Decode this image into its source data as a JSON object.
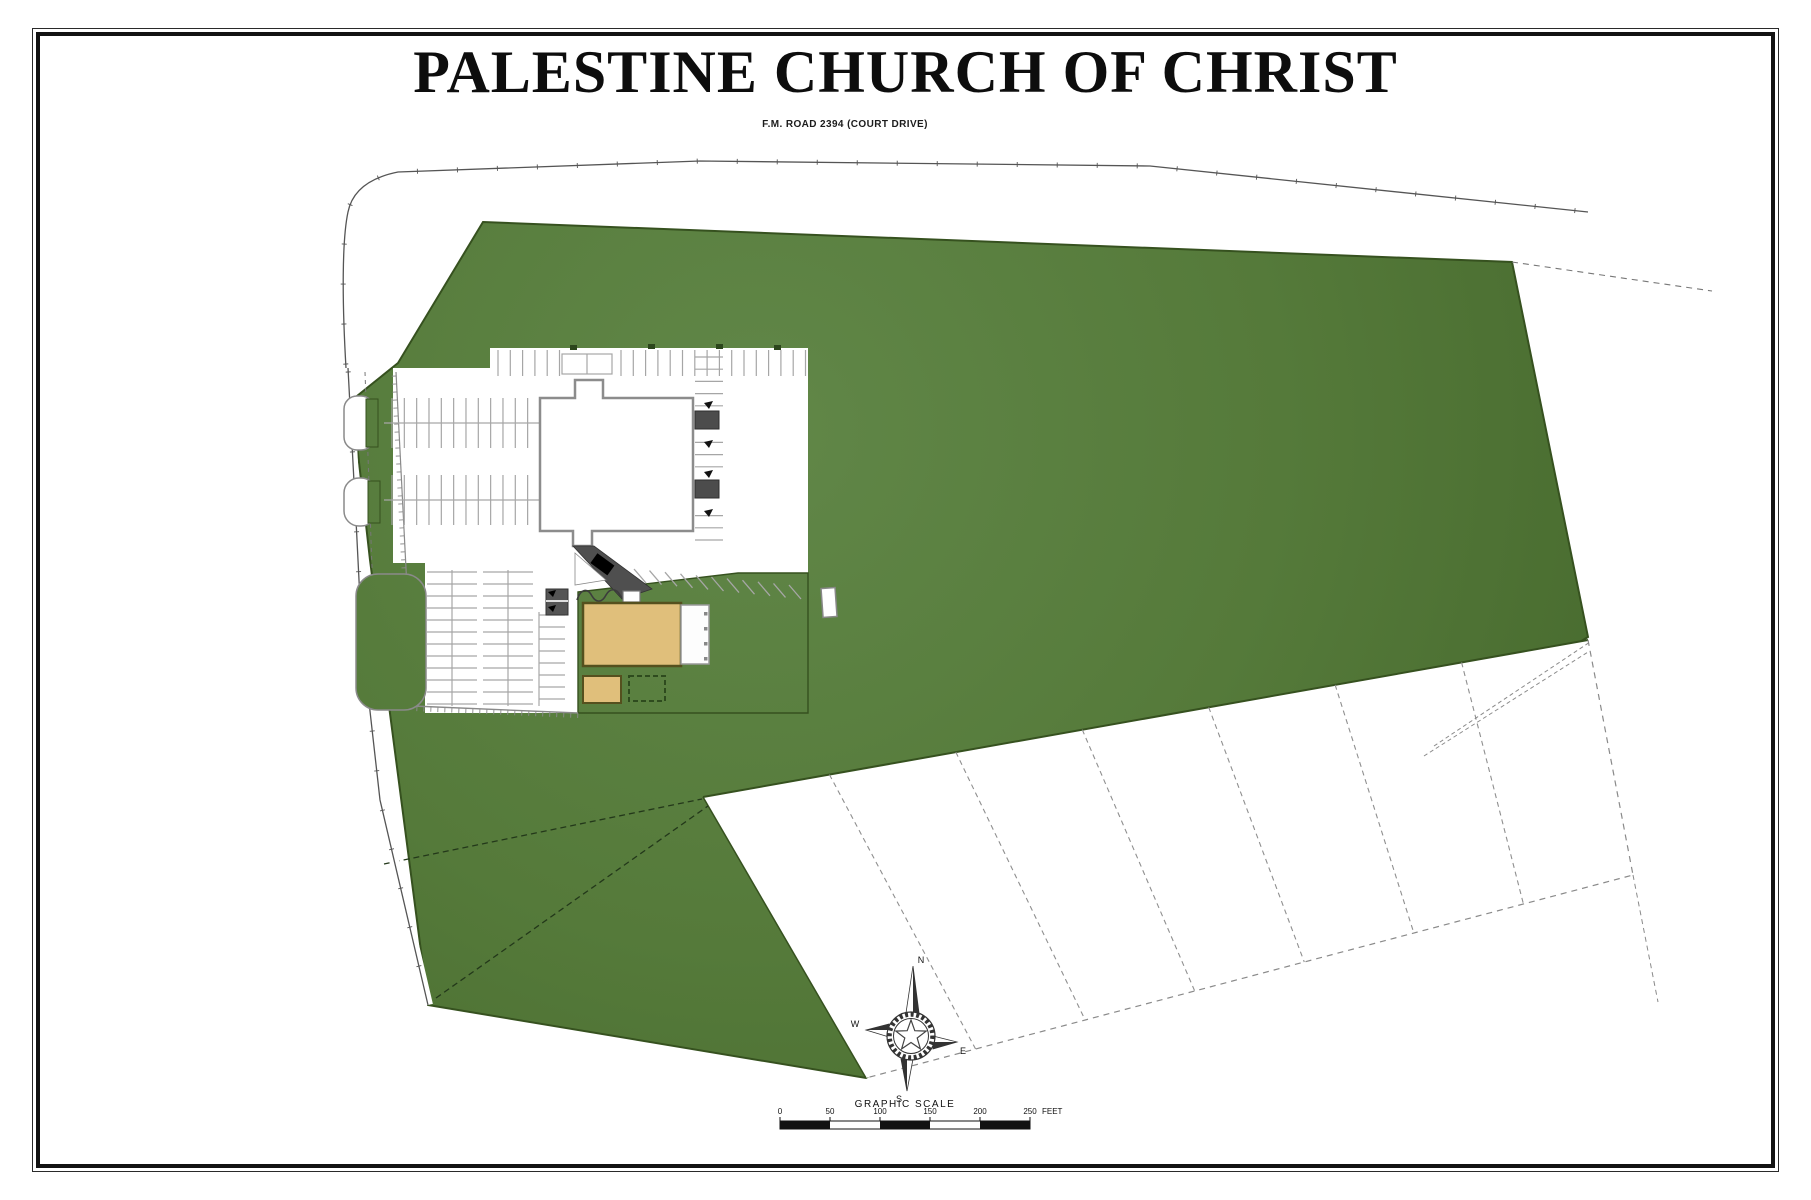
{
  "sheet": {
    "title": "PALESTINE CHURCH OF CHRIST",
    "road_label": "F.M. ROAD 2394 (COURT DRIVE)"
  },
  "compass": {
    "n": "N",
    "s": "S",
    "e": "E",
    "w": "W"
  },
  "scale": {
    "label": "GRAPHIC SCALE",
    "ticks": [
      "0",
      "50",
      "100",
      "150",
      "200",
      "250"
    ],
    "unit": "FEET"
  },
  "legend_colors": {
    "site_green_light": "#618748",
    "site_green": "#557a3a",
    "site_green_dark": "#476a2e",
    "green_edge": "#36511f",
    "building_tan": "#e0bf7b",
    "tan_edge": "#55501e",
    "canopy_gray": "#4c4c4c",
    "line_gray": "#a6a6a6"
  }
}
